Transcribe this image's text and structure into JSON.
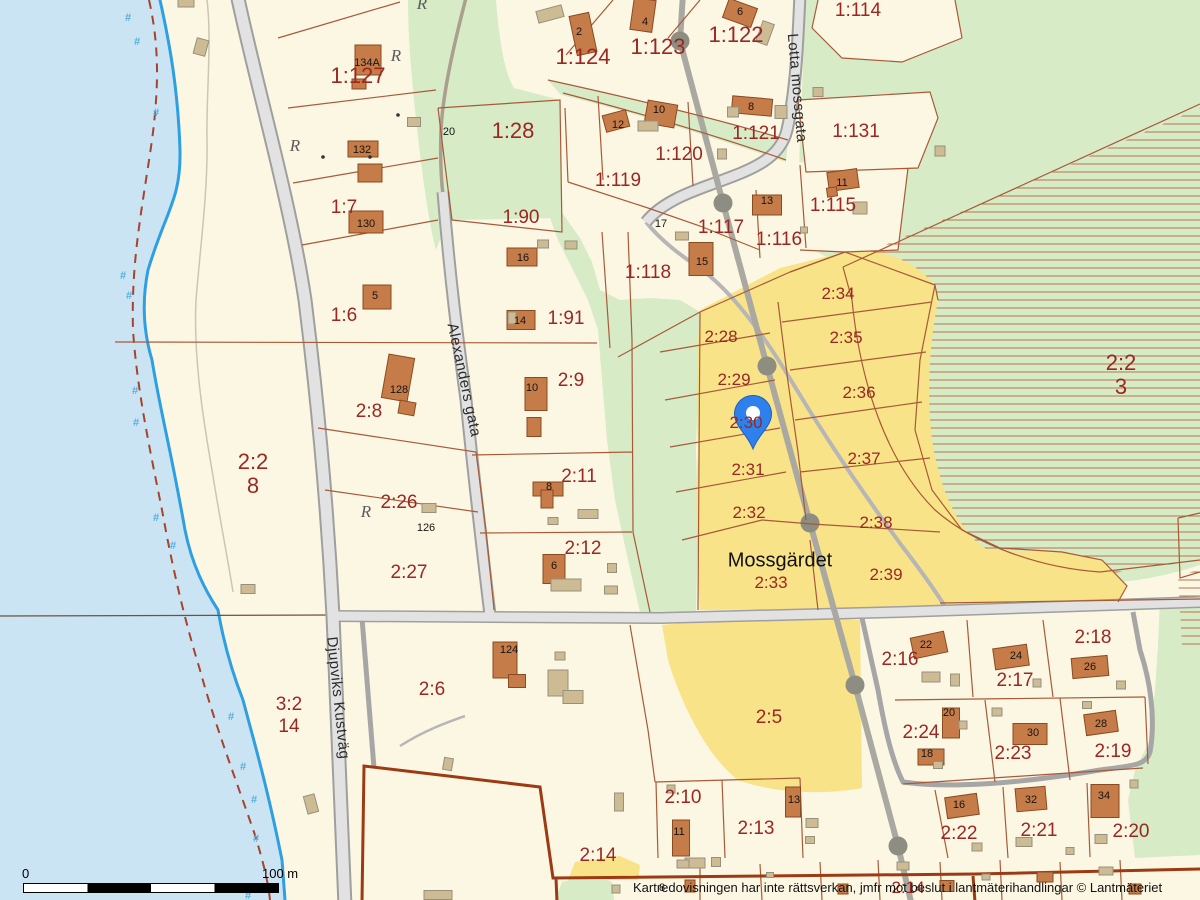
{
  "map": {
    "place_label": "Mossgärdet",
    "attribution": "Kartredovisningen har inte rättsverkan, jmfr mot beslut i lantmäterihandlingar © Lantmäteriet",
    "scale_bar": {
      "start": "0",
      "end": "100 m"
    },
    "streets": [
      [
        "Lotta mossgata",
        797,
        88,
        85
      ],
      [
        "Alexanders gata",
        464,
        380,
        78
      ],
      [
        "Djupviks Kustväg",
        338,
        698,
        84
      ]
    ],
    "parcel_labels": [
      [
        "1:127",
        358,
        76,
        "lg"
      ],
      [
        "1:7",
        344,
        208,
        ""
      ],
      [
        "1:6",
        344,
        316,
        ""
      ],
      [
        "2:8",
        369,
        412,
        ""
      ],
      [
        "2:26",
        399,
        503,
        ""
      ],
      [
        "2:27",
        409,
        573,
        ""
      ],
      [
        "2:2",
        253,
        462,
        "lg"
      ],
      [
        "8",
        253,
        486,
        "lg"
      ],
      [
        "3:2",
        289,
        705,
        ""
      ],
      [
        "14",
        289,
        727,
        ""
      ],
      [
        "1:28",
        513,
        131,
        "lg"
      ],
      [
        "1:90",
        521,
        218,
        ""
      ],
      [
        "1:91",
        566,
        319,
        ""
      ],
      [
        "2:9",
        571,
        381,
        ""
      ],
      [
        "2:11",
        579,
        477,
        ""
      ],
      [
        "2:12",
        583,
        549,
        ""
      ],
      [
        "1:124",
        583,
        57,
        "lg"
      ],
      [
        "1:123",
        658,
        47,
        "lg"
      ],
      [
        "1:122",
        736,
        35,
        "lg"
      ],
      [
        "1:114",
        858,
        11,
        ""
      ],
      [
        "1:131",
        856,
        132,
        ""
      ],
      [
        "1:121",
        756,
        134,
        ""
      ],
      [
        "1:120",
        679,
        155,
        ""
      ],
      [
        "1:119",
        618,
        181,
        ""
      ],
      [
        "1:115",
        833,
        206,
        ""
      ],
      [
        "1:116",
        779,
        240,
        ""
      ],
      [
        "1:117",
        721,
        228,
        ""
      ],
      [
        "1:118",
        648,
        273,
        ""
      ],
      [
        "2:34",
        838,
        294,
        "sm"
      ],
      [
        "2:35",
        846,
        338,
        "sm"
      ],
      [
        "2:36",
        859,
        393,
        "sm"
      ],
      [
        "2:37",
        864,
        459,
        "sm"
      ],
      [
        "2:38",
        876,
        523,
        "sm"
      ],
      [
        "2:39",
        886,
        575,
        "sm"
      ],
      [
        "2:28",
        721,
        337,
        "sm"
      ],
      [
        "2:29",
        734,
        380,
        "sm"
      ],
      [
        "2:30",
        746,
        423,
        "sm"
      ],
      [
        "2:31",
        748,
        470,
        "sm"
      ],
      [
        "2:32",
        749,
        513,
        "sm"
      ],
      [
        "2:33",
        771,
        583,
        "sm"
      ],
      [
        "2:2",
        1121,
        363,
        "lg"
      ],
      [
        "3",
        1121,
        387,
        "lg"
      ],
      [
        "2:6",
        432,
        690,
        ""
      ],
      [
        "2:5",
        769,
        718,
        ""
      ],
      [
        "2:14",
        598,
        856,
        ""
      ],
      [
        "2:10",
        683,
        798,
        ""
      ],
      [
        "2:13",
        756,
        829,
        ""
      ],
      [
        "2:16",
        900,
        660,
        ""
      ],
      [
        "2:17",
        1015,
        681,
        ""
      ],
      [
        "2:18",
        1093,
        638,
        ""
      ],
      [
        "2:24",
        921,
        733,
        ""
      ],
      [
        "2:23",
        1013,
        754,
        ""
      ],
      [
        "2:19",
        1113,
        752,
        ""
      ],
      [
        "2:22",
        959,
        834,
        ""
      ],
      [
        "2:21",
        1039,
        831,
        ""
      ],
      [
        "2:20",
        1131,
        832,
        ""
      ],
      [
        "2:14",
        908,
        888,
        "sm"
      ]
    ],
    "house_numbers": [
      [
        "134A",
        367,
        63
      ],
      [
        "132",
        362,
        150
      ],
      [
        "130",
        366,
        224
      ],
      [
        "5",
        375,
        296
      ],
      [
        "16",
        523,
        258
      ],
      [
        "14",
        520,
        321
      ],
      [
        "128",
        399,
        390
      ],
      [
        "10",
        532,
        388
      ],
      [
        "8",
        549,
        487
      ],
      [
        "6",
        554,
        566
      ],
      [
        "126",
        426,
        528
      ],
      [
        "124",
        509,
        650
      ],
      [
        "20",
        449,
        132
      ],
      [
        "2",
        579,
        32
      ],
      [
        "4",
        645,
        22
      ],
      [
        "6",
        740,
        12
      ],
      [
        "12",
        618,
        125
      ],
      [
        "10",
        659,
        110
      ],
      [
        "8",
        751,
        107
      ],
      [
        "13",
        767,
        201
      ],
      [
        "11",
        842,
        183
      ],
      [
        "15",
        702,
        262
      ],
      [
        "17",
        661,
        224
      ],
      [
        "11",
        679,
        832
      ],
      [
        "13",
        794,
        800
      ],
      [
        "22",
        926,
        645
      ],
      [
        "24",
        1016,
        656
      ],
      [
        "26",
        1090,
        667
      ],
      [
        "20",
        949,
        713
      ],
      [
        "18",
        927,
        754
      ],
      [
        "30",
        1033,
        733
      ],
      [
        "28",
        1101,
        724
      ],
      [
        "16",
        959,
        805
      ],
      [
        "32",
        1031,
        800
      ],
      [
        "34",
        1104,
        796
      ],
      [
        "8",
        662,
        888
      ]
    ],
    "monument_symbol": "R",
    "monuments": [
      [
        422,
        4
      ],
      [
        396,
        56
      ],
      [
        295,
        146
      ],
      [
        366,
        512
      ]
    ],
    "marsh_symbol": "#",
    "marsh_symbols": [
      [
        128,
        18
      ],
      [
        137,
        42
      ],
      [
        156,
        113
      ],
      [
        123,
        276
      ],
      [
        129,
        296
      ],
      [
        135,
        391
      ],
      [
        136,
        423
      ],
      [
        156,
        518
      ],
      [
        173,
        546
      ],
      [
        231,
        717
      ],
      [
        243,
        767
      ],
      [
        254,
        800
      ],
      [
        256,
        839
      ],
      [
        248,
        896
      ]
    ],
    "pin": {
      "x": 753,
      "y": 449
    },
    "buildings": {
      "main": [
        [
          583,
          34,
          20,
          40,
          -12
        ],
        [
          643,
          15,
          22,
          32,
          8
        ],
        [
          740,
          13,
          30,
          20,
          20
        ],
        [
          368,
          60,
          26,
          30,
          0
        ],
        [
          359,
          84,
          14,
          10,
          0
        ],
        [
          363,
          149,
          30,
          16,
          0
        ],
        [
          370,
          173,
          24,
          18,
          0
        ],
        [
          366,
          222,
          34,
          22,
          0
        ],
        [
          377,
          297,
          28,
          24,
          0
        ],
        [
          522,
          257,
          30,
          18,
          0
        ],
        [
          521,
          320,
          28,
          19,
          0
        ],
        [
          398,
          378,
          26,
          44,
          10
        ],
        [
          407,
          408,
          16,
          13,
          10
        ],
        [
          536,
          394,
          22,
          33,
          0
        ],
        [
          534,
          427,
          14,
          19,
          0
        ],
        [
          548,
          489,
          30,
          14,
          0
        ],
        [
          547,
          499,
          12,
          18,
          0
        ],
        [
          554,
          569,
          22,
          29,
          0
        ],
        [
          616,
          121,
          24,
          17,
          -15
        ],
        [
          661,
          114,
          30,
          23,
          10
        ],
        [
          752,
          106,
          40,
          17,
          5
        ],
        [
          767,
          205,
          29,
          20,
          0
        ],
        [
          701,
          259,
          24,
          33,
          0
        ],
        [
          843,
          180,
          30,
          19,
          -8
        ],
        [
          832,
          192,
          10,
          9,
          -8
        ],
        [
          505,
          660,
          24,
          36,
          0
        ],
        [
          517,
          681,
          17,
          13,
          0
        ],
        [
          681,
          838,
          17,
          36,
          0
        ],
        [
          793,
          802,
          15,
          30,
          0
        ],
        [
          929,
          645,
          34,
          21,
          -12
        ],
        [
          1011,
          657,
          34,
          21,
          -8
        ],
        [
          1090,
          667,
          36,
          20,
          -5
        ],
        [
          951,
          723,
          17,
          30,
          0
        ],
        [
          931,
          757,
          26,
          16,
          0
        ],
        [
          1030,
          734,
          34,
          21,
          0
        ],
        [
          1101,
          723,
          32,
          21,
          -8
        ],
        [
          962,
          806,
          32,
          21,
          -8
        ],
        [
          1031,
          799,
          30,
          23,
          -5
        ],
        [
          1105,
          801,
          28,
          33,
          0
        ],
        [
          690,
          886,
          10,
          12,
          0
        ],
        [
          843,
          889,
          10,
          10,
          0
        ],
        [
          947,
          886,
          14,
          11,
          0
        ],
        [
          1045,
          877,
          16,
          10,
          0
        ],
        [
          1135,
          889,
          12,
          10,
          0
        ]
      ],
      "out": [
        [
          201,
          47,
          12,
          16,
          15
        ],
        [
          186,
          3,
          16,
          8,
          0
        ],
        [
          550,
          14,
          26,
          12,
          -15
        ],
        [
          765,
          33,
          12,
          22,
          20
        ],
        [
          414,
          122,
          13,
          9,
          0
        ],
        [
          543,
          244,
          11,
          8,
          0
        ],
        [
          571,
          245,
          12,
          8,
          0
        ],
        [
          512,
          318,
          8,
          12,
          0
        ],
        [
          648,
          126,
          20,
          10,
          0
        ],
        [
          733,
          112,
          11,
          10,
          0
        ],
        [
          781,
          112,
          12,
          13,
          0
        ],
        [
          722,
          154,
          9,
          10,
          0
        ],
        [
          860,
          208,
          14,
          12,
          0
        ],
        [
          804,
          230,
          7,
          6,
          0
        ],
        [
          682,
          236,
          13,
          8,
          0
        ],
        [
          818,
          92,
          10,
          9,
          0
        ],
        [
          940,
          151,
          10,
          10,
          0
        ],
        [
          429,
          508,
          14,
          9,
          0
        ],
        [
          553,
          521,
          10,
          7,
          0
        ],
        [
          588,
          514,
          20,
          9,
          0
        ],
        [
          566,
          585,
          30,
          12,
          0
        ],
        [
          612,
          568,
          9,
          9,
          0
        ],
        [
          611,
          590,
          13,
          8,
          0
        ],
        [
          560,
          656,
          10,
          8,
          0
        ],
        [
          558,
          683,
          20,
          26,
          0
        ],
        [
          573,
          697,
          20,
          13,
          0
        ],
        [
          448,
          764,
          9,
          12,
          10
        ],
        [
          311,
          804,
          11,
          18,
          -15
        ],
        [
          248,
          589,
          14,
          9,
          0
        ],
        [
          671,
          789,
          8,
          8,
          0
        ],
        [
          695,
          863,
          20,
          10,
          0
        ],
        [
          716,
          862,
          9,
          9,
          0
        ],
        [
          812,
          823,
          12,
          9,
          0
        ],
        [
          810,
          840,
          9,
          7,
          0
        ],
        [
          619,
          802,
          9,
          18,
          0
        ],
        [
          931,
          677,
          18,
          10,
          0
        ],
        [
          955,
          680,
          9,
          12,
          0
        ],
        [
          1037,
          683,
          8,
          8,
          0
        ],
        [
          1121,
          685,
          9,
          8,
          0
        ],
        [
          963,
          725,
          8,
          8,
          0
        ],
        [
          938,
          765,
          9,
          7,
          0
        ],
        [
          997,
          712,
          10,
          8,
          0
        ],
        [
          1087,
          705,
          9,
          7,
          0
        ],
        [
          1134,
          784,
          8,
          8,
          0
        ],
        [
          977,
          847,
          10,
          8,
          0
        ],
        [
          1024,
          842,
          16,
          9,
          0
        ],
        [
          1070,
          851,
          8,
          7,
          0
        ],
        [
          1101,
          839,
          12,
          9,
          0
        ],
        [
          683,
          864,
          12,
          8,
          0
        ],
        [
          903,
          866,
          12,
          8,
          0
        ],
        [
          986,
          877,
          8,
          6,
          0
        ],
        [
          1106,
          871,
          14,
          8,
          0
        ],
        [
          770,
          875,
          7,
          5,
          0
        ],
        [
          438,
          895,
          28,
          9,
          0
        ],
        [
          616,
          889,
          8,
          8,
          0
        ]
      ]
    },
    "survey_dots": [
      [
        398,
        115
      ],
      [
        370,
        157
      ],
      [
        323,
        157
      ]
    ],
    "power_poles": [
      [
        680,
        41
      ],
      [
        723,
        203
      ],
      [
        767,
        366
      ],
      [
        810,
        523
      ],
      [
        855,
        685
      ],
      [
        898,
        846
      ]
    ],
    "colors": {
      "water": "#cbe4f4",
      "land": "#fcf7e3",
      "forest": "#d7ebc6",
      "field": "#f9e388",
      "road_fill": "#e2e2e2",
      "road_casing": "#9f9f9f",
      "building": "#c67c48",
      "outbuilding": "#cdbb94",
      "boundary": "#a85a38",
      "boundary_thick": "#9c3a14",
      "parcel_text": "#9b2723",
      "shoreline": "#2e9fe0",
      "pin": "#2e80ec"
    }
  }
}
